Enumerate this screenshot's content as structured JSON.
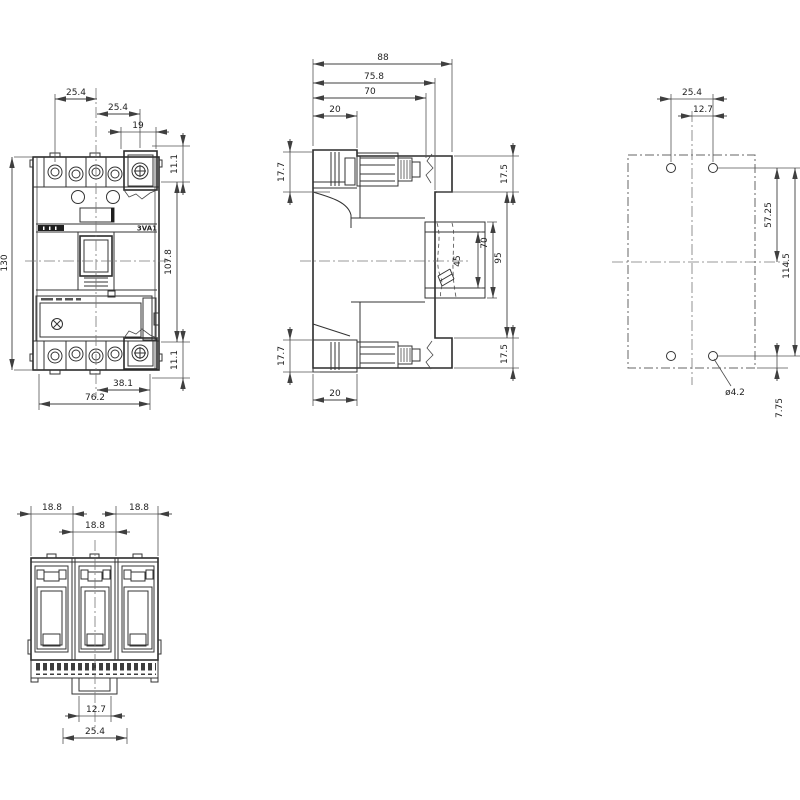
{
  "drawing": {
    "front_view": {
      "product_label": "3VA1",
      "dims": {
        "pitch_left": "25.4",
        "pitch_right": "25.4",
        "terminal_width": "19",
        "height": "130",
        "top_offset": "11.1",
        "mounting_pitch": "107.8",
        "bottom_offset": "11.1",
        "lower_span": "38.1",
        "width": "76.2"
      }
    },
    "side_view": {
      "dims": {
        "total_depth": "88",
        "rear_depth": "75.8",
        "body_depth": "70",
        "top_terminal_depth": "20",
        "top_terminal_height": "17.7",
        "bottom_terminal_height": "17.7",
        "rear_top_height": "17.5",
        "rear_bottom_height": "17.5",
        "bracket_height": "45",
        "bracket_span": "70",
        "rear_height": "95",
        "bottom_terminal_depth": "20"
      }
    },
    "drilling_plan": {
      "dims": {
        "hole_pitch": "25.4",
        "half_pitch": "12.7",
        "center_offset": "57.25",
        "vertical_pitch": "114.5",
        "edge_offset": "7.75",
        "hole_diameter": "ø4.2"
      }
    },
    "bottom_view": {
      "dims": {
        "pole_left": "18.8",
        "pole_middle": "18.8",
        "pole_right": "18.8",
        "slot_width": "12.7",
        "slot_pitch": "25.4"
      }
    }
  }
}
